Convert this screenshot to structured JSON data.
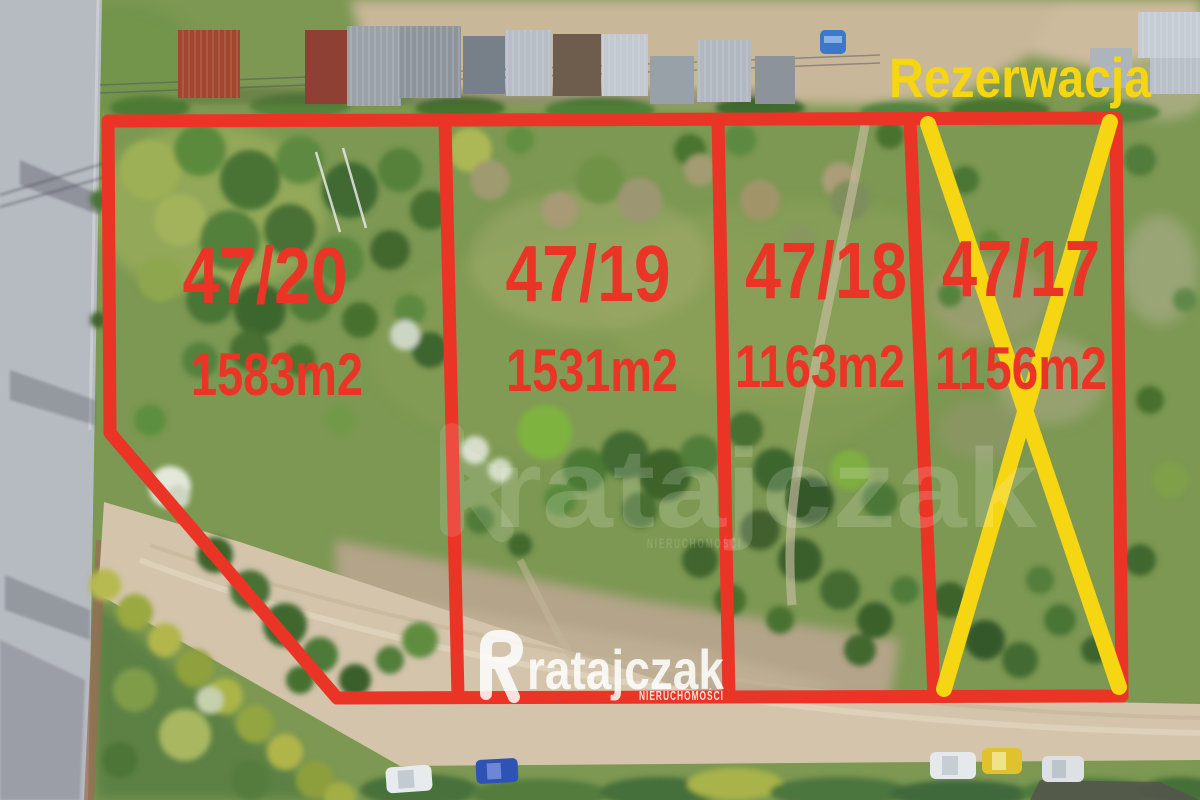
{
  "photo": {
    "description": "Aerial drone photo of four land plots outlined for sale"
  },
  "plots": [
    {
      "number": "47/20",
      "area": "1583m2"
    },
    {
      "number": "47/19",
      "area": "1531m2"
    },
    {
      "number": "47/18",
      "area": "1163m2"
    },
    {
      "number": "47/17",
      "area": "1156m2",
      "status": "reserved"
    }
  ],
  "reservation": {
    "label": "Rezerwacja"
  },
  "branding": {
    "logo_text": "ratajczak",
    "logo_tagline": "NIERUCHOMOŚCI"
  },
  "watermark": {
    "text": "ratajczak",
    "tagline": "NIERUCHOMOŚCI"
  },
  "colors": {
    "plot_outline": "#ea3425",
    "plot_label": "#ea3425",
    "reservation_mark": "#f6d512",
    "reservation_text": "#f6d512",
    "logo": "#ffffff"
  }
}
